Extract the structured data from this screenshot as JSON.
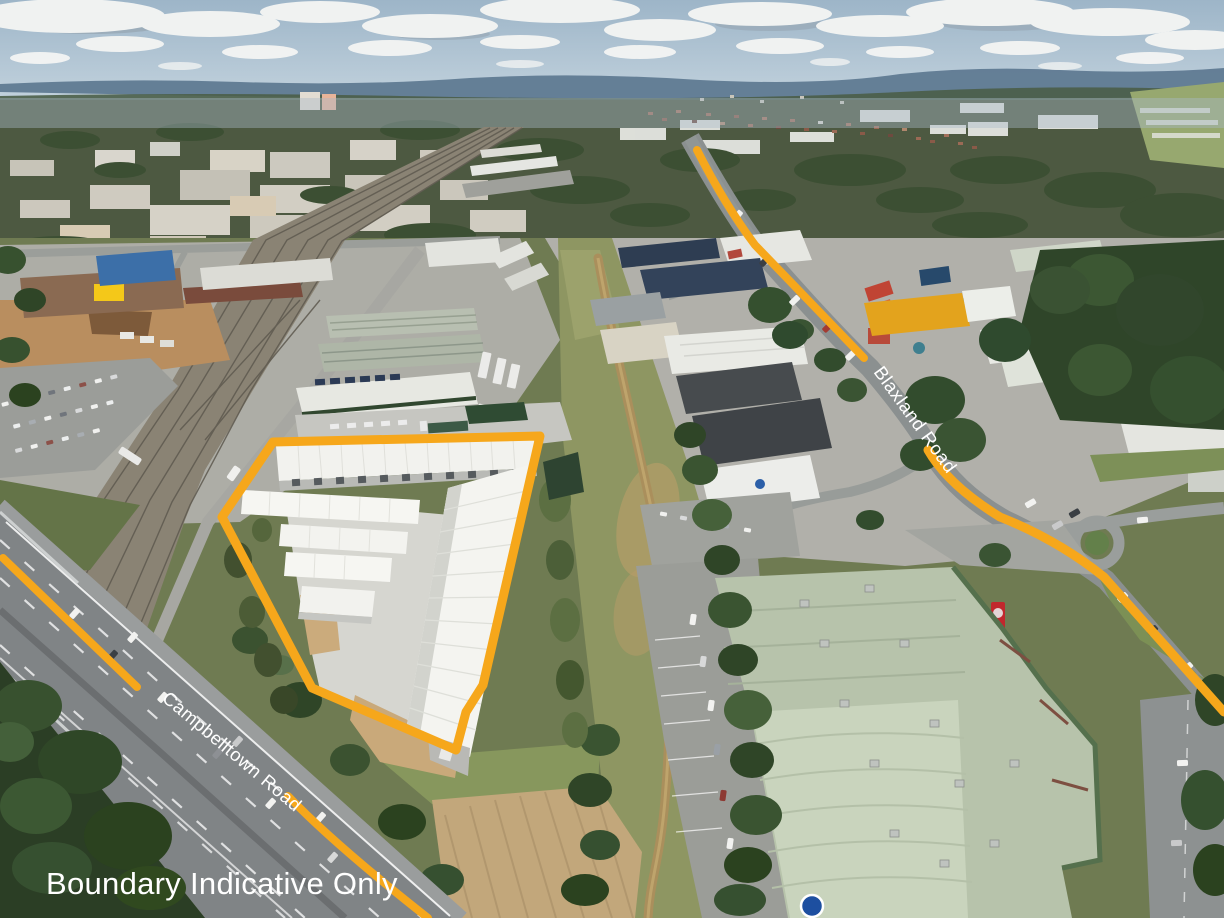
{
  "image": {
    "type": "aerial-drone-photograph",
    "description": "Oblique aerial view of an industrial and commercial precinct with a highlighted property boundary"
  },
  "annotations": {
    "accent_color": "#F6A71B",
    "text_color": "#FFFFFF",
    "disclaimer": {
      "text": "Boundary Indicative Only",
      "x": 46,
      "y": 894,
      "font_size": 31
    },
    "boundary": {
      "label": "property-boundary",
      "points": "273,442 540,436 483,685 466,712 456,750 312,688 222,517",
      "stroke_width": 9
    },
    "road_labels": [
      {
        "id": "campbelltown",
        "text": "Campbelltown Road",
        "transform": "translate(161,700) rotate(40)",
        "font_size": 18.5
      },
      {
        "id": "blaxland",
        "text": "Blaxland Road",
        "transform": "translate(873,372) rotate(54)",
        "font_size": 18.5
      }
    ],
    "road_lines": [
      {
        "id": "campbelltown-upper",
        "d": "M 3 558 L 137 687",
        "width": 8
      },
      {
        "id": "campbelltown-lower",
        "d": "M 288 796 Q 334 844 428 918",
        "width": 8
      },
      {
        "id": "blaxland-upper",
        "d": "M 697 150 Q 725 205 755 245 L 864 358",
        "width": 8
      },
      {
        "id": "blaxland-lower",
        "d": "M 928 450 Q 948 485 1000 517 Q 1058 540 1104 577 L 1224 712",
        "width": 9
      }
    ]
  },
  "scene": {
    "palette": {
      "sky": "#9DB5C8",
      "clouds": "#F3F4F3",
      "distant_hills": "#5F7A92",
      "vegetation": "#3A5230",
      "grass": "#7C8A55",
      "asphalt": "#8B9090",
      "railway": "#8A8374",
      "storage_roof_white": "#F2F2EE",
      "retail_roof_green": "#B7C3AB",
      "warehouse_yellow": "#E3A31D",
      "dirt": "#C2A77B"
    },
    "features": [
      "white self-storage buildings inside orange boundary",
      "railway corridor",
      "Campbelltown Road highway",
      "Blaxland Road",
      "green-roofed retail store",
      "industrial warehouses",
      "creek corridor with dirt track",
      "construction site",
      "car dealership lots",
      "roundabout"
    ]
  }
}
